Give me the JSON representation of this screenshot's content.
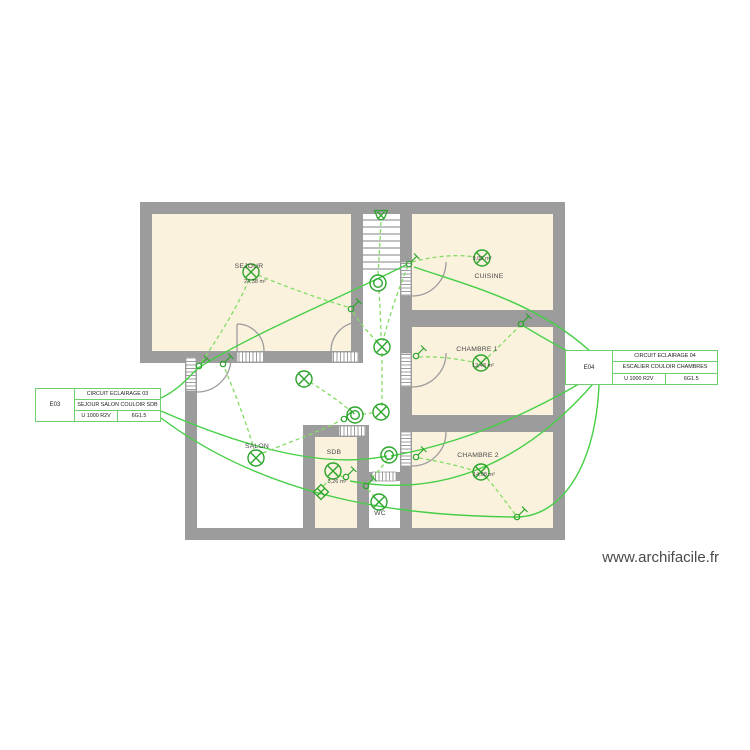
{
  "watermark": "www.archifacile.fr",
  "rooms": [
    {
      "name": "SEJOUR",
      "area": "24,38 m²"
    },
    {
      "name": "CUISINE",
      "area": "9,06 m²"
    },
    {
      "name": "CHAMBRE 1",
      "area": "12,43 m²"
    },
    {
      "name": "CHAMBRE 2",
      "area": "14,08 m²"
    },
    {
      "name": "SALON",
      "area": ""
    },
    {
      "name": "SDB",
      "area": "3,26 m²"
    },
    {
      "name": "WC",
      "area": ""
    }
  ],
  "circuits": [
    {
      "code": "E03",
      "title": "CIRCUIT ECLAIRAGE 03",
      "rooms": "SEJOUR SALON COULOIR SDB",
      "cable": "U 1000 R2V",
      "section": "6G1.5"
    },
    {
      "code": "E04",
      "title": "CIRCUIT ECLAIRAGE 04",
      "rooms": "ESCALIER COULOIR CHAMBRES",
      "cable": "U 1000 R2V",
      "section": "6G1.5"
    }
  ],
  "colors": {
    "wall": "#9c9c9c",
    "room_fill": "#faf2dd",
    "symbol_green": "#2da52d",
    "wire_solid_green": "#46cf46",
    "wire_dashed_green": "#84dc66",
    "box_border_green": "#6fcf6f"
  }
}
